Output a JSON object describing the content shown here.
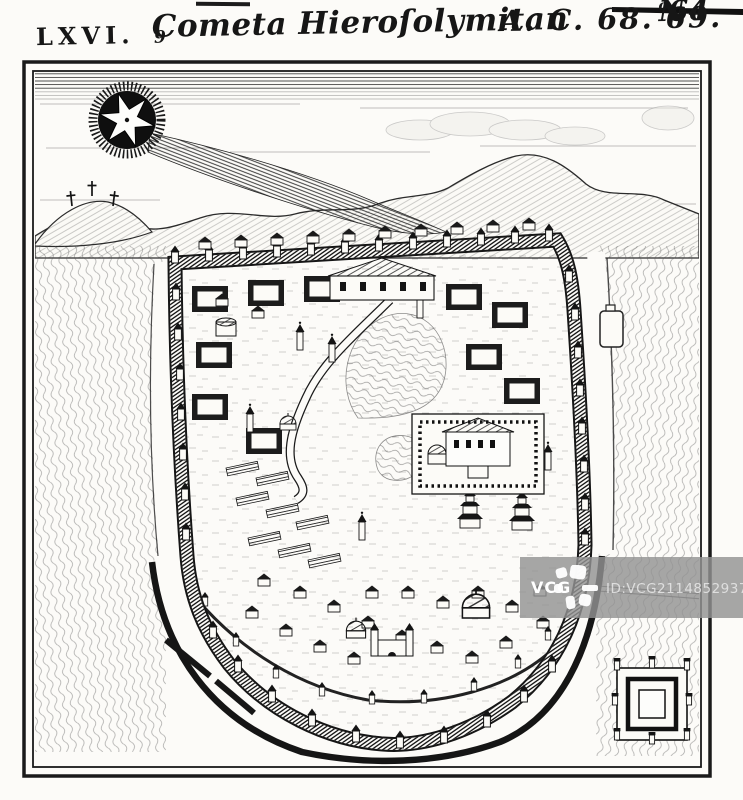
{
  "document": {
    "plate_title": {
      "numeral": "LXVI.",
      "name": "Cometa Hieroſolymitan",
      "name_suffix": "9",
      "date": "A. C. 68. 69.",
      "plate_no_prefix": "N",
      "plate_no_sup": "o",
      "plate_no_num": "64"
    }
  },
  "watermark": {
    "brand": "VCG",
    "id_text": "ID:VCG211485293722"
  },
  "colors": {
    "paper": "#fcfbf8",
    "ink": "#161616",
    "watermark_bar": "#929292",
    "watermark_brand_text": "#ffffff",
    "watermark_id_text": "#ececec"
  },
  "icons": {
    "comet": "comet-star-icon",
    "crosses": "calvary-crosses-icon",
    "fort": "square-fort-icon",
    "watermark_logo": "vcg-pinwheel-icon"
  }
}
